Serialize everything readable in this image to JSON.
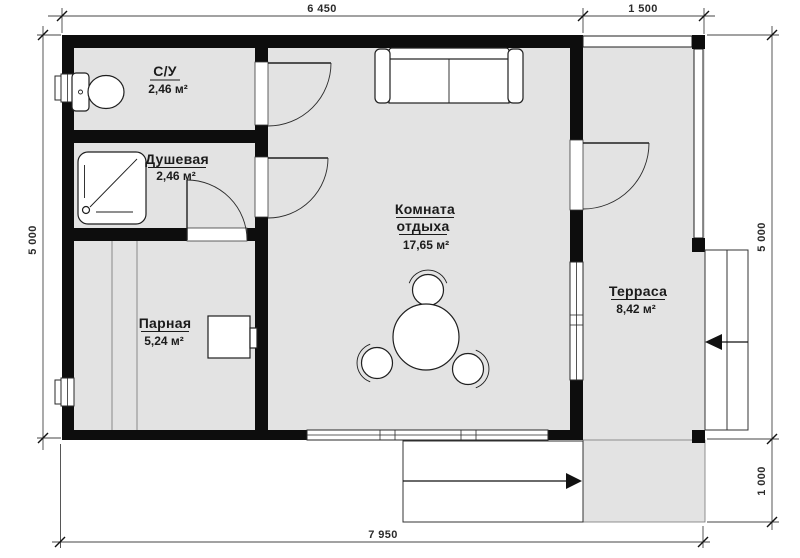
{
  "plan": {
    "rooms": {
      "wc": {
        "name": "С/У",
        "area": "2,46 м²"
      },
      "shower": {
        "name": "Душевая",
        "area": "2,46 м²"
      },
      "steam": {
        "name": "Парная",
        "area": "5,24 м²"
      },
      "lounge": {
        "name_line1": "Комната",
        "name_line2": "отдыха",
        "area": "17,65 м²"
      },
      "terrace": {
        "name": "Терраса",
        "area": "8,42 м²"
      }
    },
    "dimensions": {
      "top_main": "6 450",
      "top_terrace": "1 500",
      "left_height": "5 000",
      "right_height": "5 000",
      "right_porch": "1 000",
      "bottom_total": "7 950"
    },
    "symbols": [
      "toilet-icon",
      "shower-tray-icon",
      "sofa-icon",
      "dining-table-icon",
      "chair-icon",
      "sauna-stove-icon",
      "door-swing-icon",
      "window-icon",
      "steps-icon",
      "entry-arrow-icon"
    ],
    "colors": {
      "wall": "#0d0d0d",
      "floor": "#e3e3e3",
      "line": "#333333",
      "background": "#ffffff"
    }
  }
}
